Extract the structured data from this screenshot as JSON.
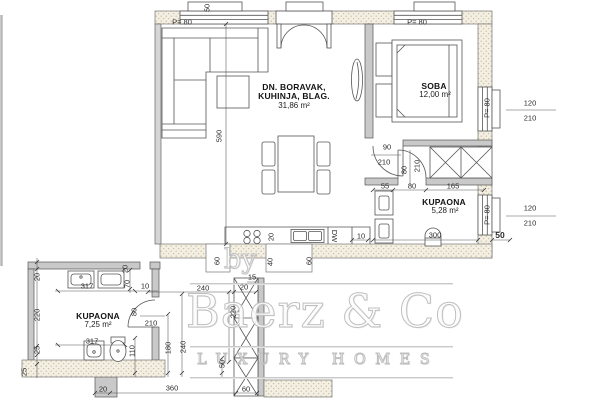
{
  "watermark": {
    "by": "by",
    "brand": "Baerz & Co",
    "tagline": "LUXURY HOMES"
  },
  "rooms": {
    "living": {
      "name_line1": "DN. BORAVAK,",
      "name_line2": "KUHINJA, BLAG.",
      "area": "31,86 m²"
    },
    "bedroom": {
      "name": "SOBA",
      "area": "12,00 m²"
    },
    "bathroom": {
      "name": "KUPAONA",
      "area": "5,28 m²"
    },
    "bathroom2": {
      "name": "KUPAONA",
      "area": "7,25 m²"
    }
  },
  "windows": {
    "top_left_parapet": "P= 80",
    "top_right_parapet": "P= 80",
    "right_upper_parapet": "P= 80",
    "right_lower_parapet": "P= 80",
    "right_upper_w": "120",
    "right_upper_h": "210",
    "right_lower_w": "120",
    "right_lower_h": "210"
  },
  "labels": {
    "dishwasher": "DW"
  },
  "dims": {
    "box50": "50",
    "living590": "590",
    "beddoor_w": "90",
    "beddoor_h": "210",
    "seg55": "55",
    "bathdoor80": "80",
    "closet165": "165",
    "bath300": "300",
    "counter10": "10",
    "corner50": "50",
    "stove20": "20",
    "entry60": "60",
    "niche40": "40",
    "niche60": "60",
    "hall240": "240",
    "shaft20": "20",
    "shaft15": "15",
    "hall220": "220",
    "shaft50": "50",
    "hall180": "180",
    "hall240v": "240",
    "bottom20": "20",
    "bottom360": "360",
    "bottom60": "60",
    "b2left20": "20",
    "b2left220": "220",
    "b2left25a": "25",
    "b2left25b": "25",
    "b2top317": "317",
    "b2bot317": "317",
    "b2toilet110": "110",
    "b2jamb70": "70",
    "b2gap10": "10",
    "b2tick20": "20",
    "b2door80": "80",
    "b2door210": "210",
    "bathdoor80rot": "80",
    "bathdoor210rot": "210"
  }
}
